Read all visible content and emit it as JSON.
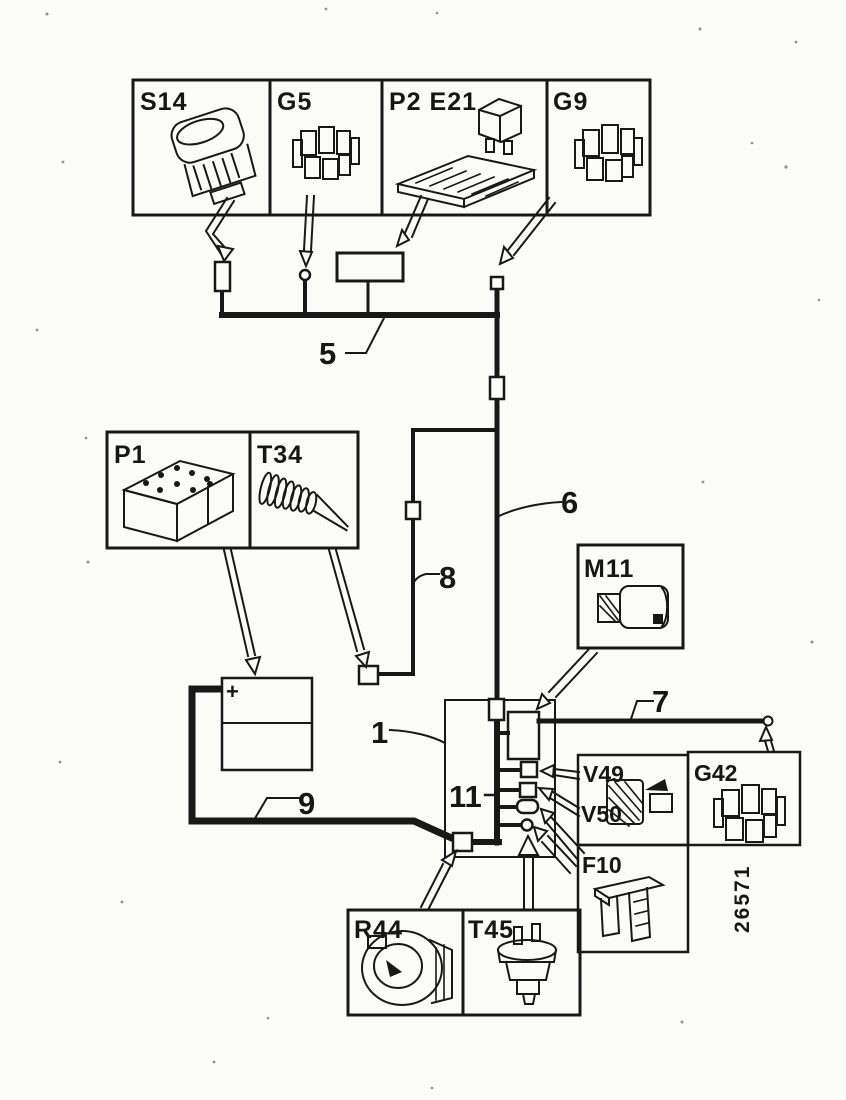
{
  "diagram": {
    "part_number": "26571",
    "battery_plus": "+",
    "colors": {
      "ink": "#181818",
      "paper": "#fbfbf8"
    },
    "boxes": {
      "s14": {
        "label": "S14",
        "icon": "rocker-switch-icon"
      },
      "g5": {
        "label": "G5",
        "icon": "connector-block-icon"
      },
      "p2e21": {
        "label": "P2 E21",
        "icon": "relay-and-fuse-panel-icon"
      },
      "g9": {
        "label": "G9",
        "icon": "connector-block-icon"
      },
      "p1": {
        "label": "P1",
        "icon": "battery-block-icon"
      },
      "t34": {
        "label": "T34",
        "icon": "cable-loom-icon"
      },
      "m11": {
        "label": "M11",
        "icon": "motor-icon"
      },
      "v49v50": {
        "label_top": "V49",
        "label_bottom": "V50",
        "icon": "pump-motor-icon"
      },
      "g42": {
        "label": "G42",
        "icon": "connector-block-icon"
      },
      "f10": {
        "label": "F10",
        "icon": "blade-fuse-icon"
      },
      "r44": {
        "label": "R44",
        "icon": "compressor-icon"
      },
      "t45": {
        "label": "T45",
        "icon": "pressure-switch-icon"
      }
    },
    "wire_labels": {
      "w1": "1",
      "w5": "5",
      "w6": "6",
      "w7": "7",
      "w8": "8",
      "w9": "9",
      "w11": "11"
    }
  }
}
